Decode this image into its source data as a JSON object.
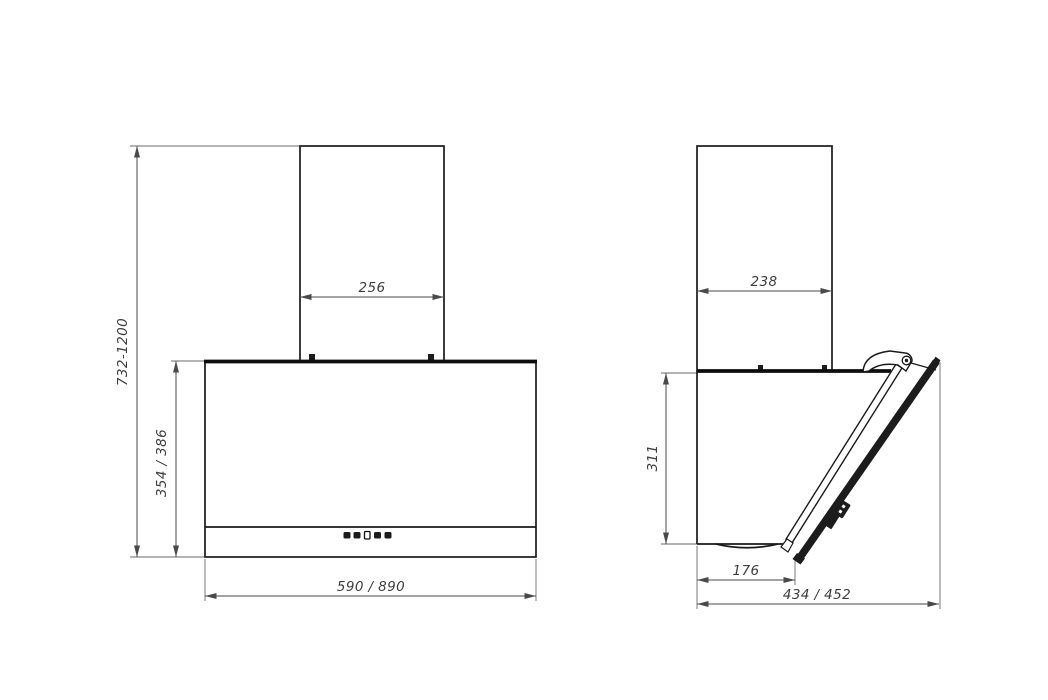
{
  "drawing": {
    "front_view": {
      "height_range_label": "732-1200",
      "chimney_width_label": "256",
      "body_height_label": "354 / 386",
      "body_width_label": "590 / 890",
      "control_buttons": [
        "filled",
        "filled",
        "outlined",
        "filled",
        "filled"
      ]
    },
    "side_view": {
      "chimney_depth_label": "238",
      "body_height_label": "311",
      "bottom_depth_label": "176",
      "total_depth_label": "434 / 452"
    },
    "colors": {
      "background": "#ffffff",
      "object_line": "#1a1a1a",
      "dimension_line": "#4a4a4a",
      "label_text": "#3d3d3d",
      "glass_fill": "#1c1c1c"
    }
  }
}
